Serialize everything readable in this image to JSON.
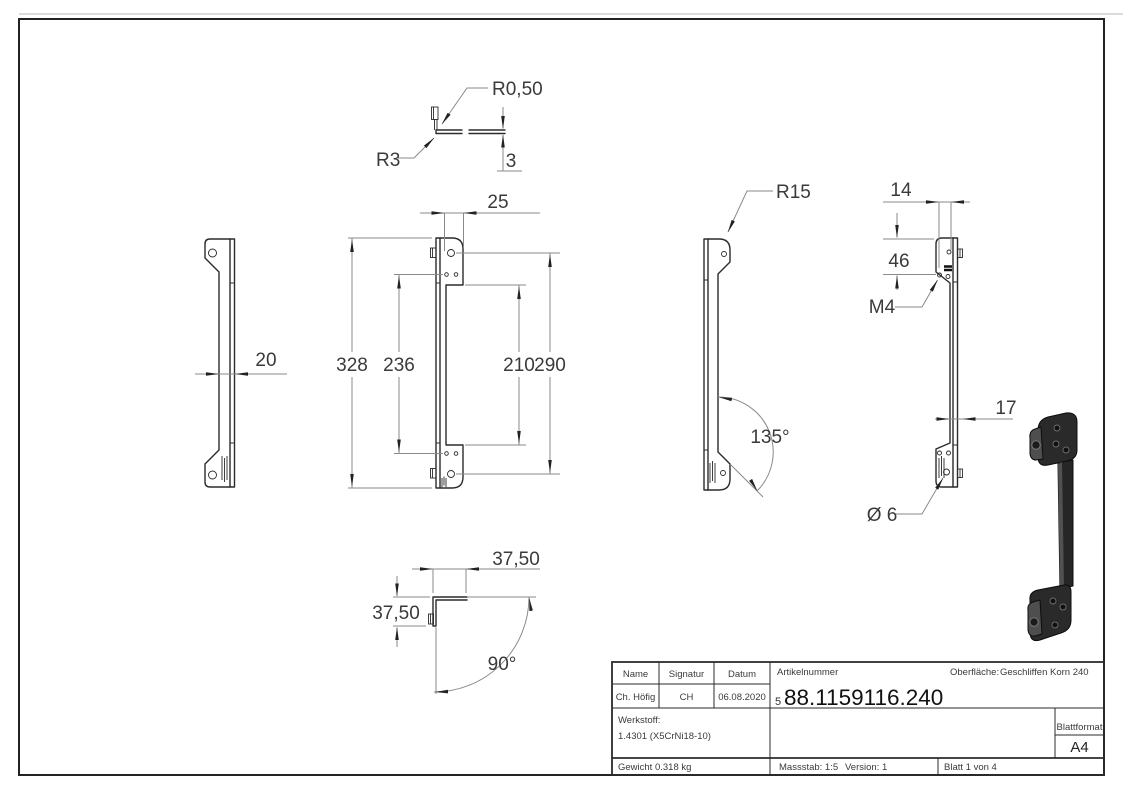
{
  "views": {
    "detail_edge": {
      "radius_small": "R0,50",
      "radius_bend": "R3",
      "thickness": "3"
    },
    "side_left": {
      "width": "20"
    },
    "front": {
      "pad_width": "25",
      "total_height": "328",
      "hole_spacing_inner": "236",
      "inner_height": "210",
      "hole_spacing_outer": "290"
    },
    "side_135": {
      "corner_radius": "R15",
      "angle": "135°"
    },
    "side_right": {
      "top_width": "14",
      "hole_offset": "46",
      "thread": "M4",
      "width": "17",
      "hole_dia": "Ø 6"
    },
    "detail_corner": {
      "leg_top": "37,50",
      "leg_left": "37,50",
      "angle": "90°"
    }
  },
  "title_block": {
    "name_label": "Name",
    "signature_label": "Signatur",
    "date_label": "Datum",
    "name_value": "Ch. Höfig",
    "signature_value": "CH",
    "date_value": "06.08.2020",
    "article_label": "Artikelnummer",
    "article_prefix": "5",
    "article_number": "88.1159116.240",
    "surface_label": "Oberfläche:",
    "surface_value": "Geschliffen Korn 240",
    "material_label": "Werkstoff:",
    "material_value": "1.4301 (X5CrNi18-10)",
    "weight": "Gewicht 0.318 kg",
    "scale": "Massstab: 1:5",
    "version": "Version: 1",
    "sheet": "Blatt 1 von 4",
    "format_label": "Blattformat",
    "format_value": "A4"
  },
  "colors": {
    "outline": "#2b2b2b",
    "dimension_lines": "#8a8a8a",
    "part_3d": "#2a2a2a",
    "page": "#ffffff"
  }
}
